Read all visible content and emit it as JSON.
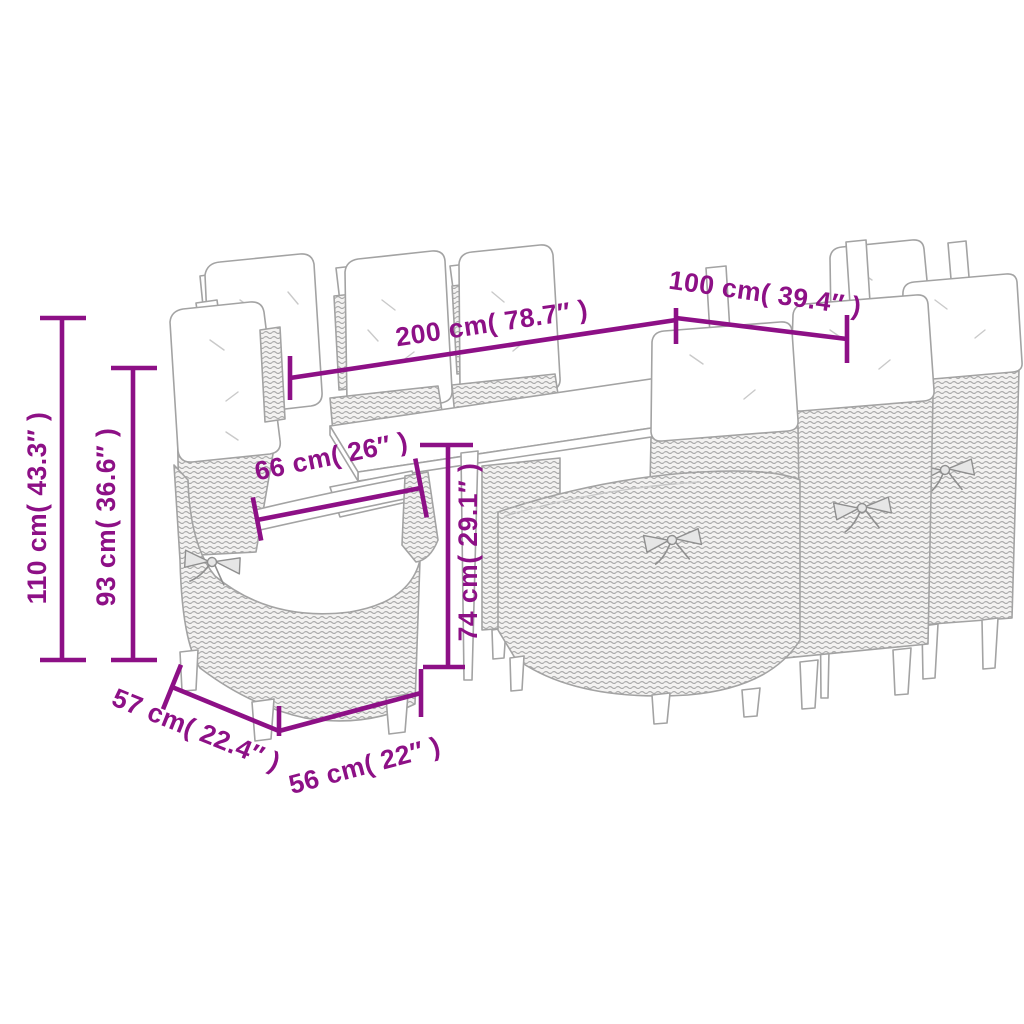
{
  "page": {
    "background": "#ffffff"
  },
  "style": {
    "dimension_color": "#8D1086",
    "line_art_color": "#a3a3a3",
    "wicker_tone": "#a6a6a6",
    "cushion_color": "#ffffff"
  },
  "product": {
    "name": "Outdoor dining set: rectangular table with 8 reclining rattan chairs with cushions"
  },
  "dimensions": {
    "table_length": {
      "label": "200 cm( 78.7″ )",
      "cm": 200,
      "inch": 78.7
    },
    "table_width": {
      "label": "100 cm( 39.4″ )",
      "cm": 100,
      "inch": 39.4
    },
    "chair_total_height": {
      "label": "110 cm( 43.3″ )",
      "cm": 110,
      "inch": 43.3
    },
    "chair_back_height": {
      "label": "93 cm( 36.6″ )",
      "cm": 93,
      "inch": 36.6
    },
    "armrest_width": {
      "label": "66 cm( 26″ )",
      "cm": 66,
      "inch": 26
    },
    "table_height": {
      "label": "74 cm( 29.1″ )",
      "cm": 74,
      "inch": 29.1
    },
    "chair_depth": {
      "label": "57 cm( 22.4″ )",
      "cm": 57,
      "inch": 22.4
    },
    "chair_width": {
      "label": "56 cm( 22″ )",
      "cm": 56,
      "inch": 22
    }
  }
}
